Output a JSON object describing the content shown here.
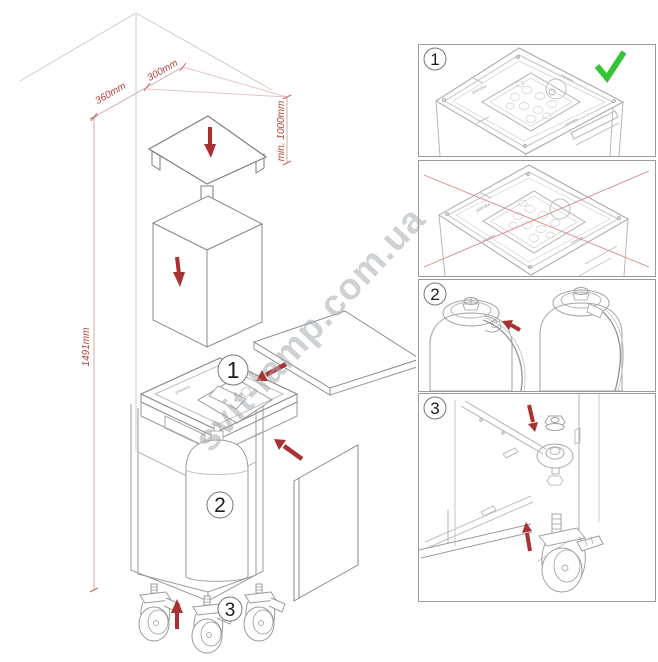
{
  "colors": {
    "red_arrow": "#a83232",
    "dim_text": "#b5403c",
    "dim_line": "#d8a8a8",
    "line_gray": "#9a9a9a",
    "check_green": "#35c435",
    "watermark_gray": "#a8aeb2"
  },
  "watermark": {
    "text": "svit-lamp.com.ua"
  },
  "left_figure": {
    "dim_width_left": "360mm",
    "dim_width_right": "300mm",
    "dim_clearance": "min. 1000mm",
    "dim_height": "1491mm",
    "step1": "1",
    "step2": "2",
    "step3": "3",
    "lid_logo": "planika"
  },
  "panels": {
    "p1": {
      "number": "1",
      "lid_logo": "planika"
    },
    "p2": {
      "lid_logo": "planika"
    },
    "p3": {
      "number": "2"
    },
    "p4": {
      "number": "3"
    }
  }
}
